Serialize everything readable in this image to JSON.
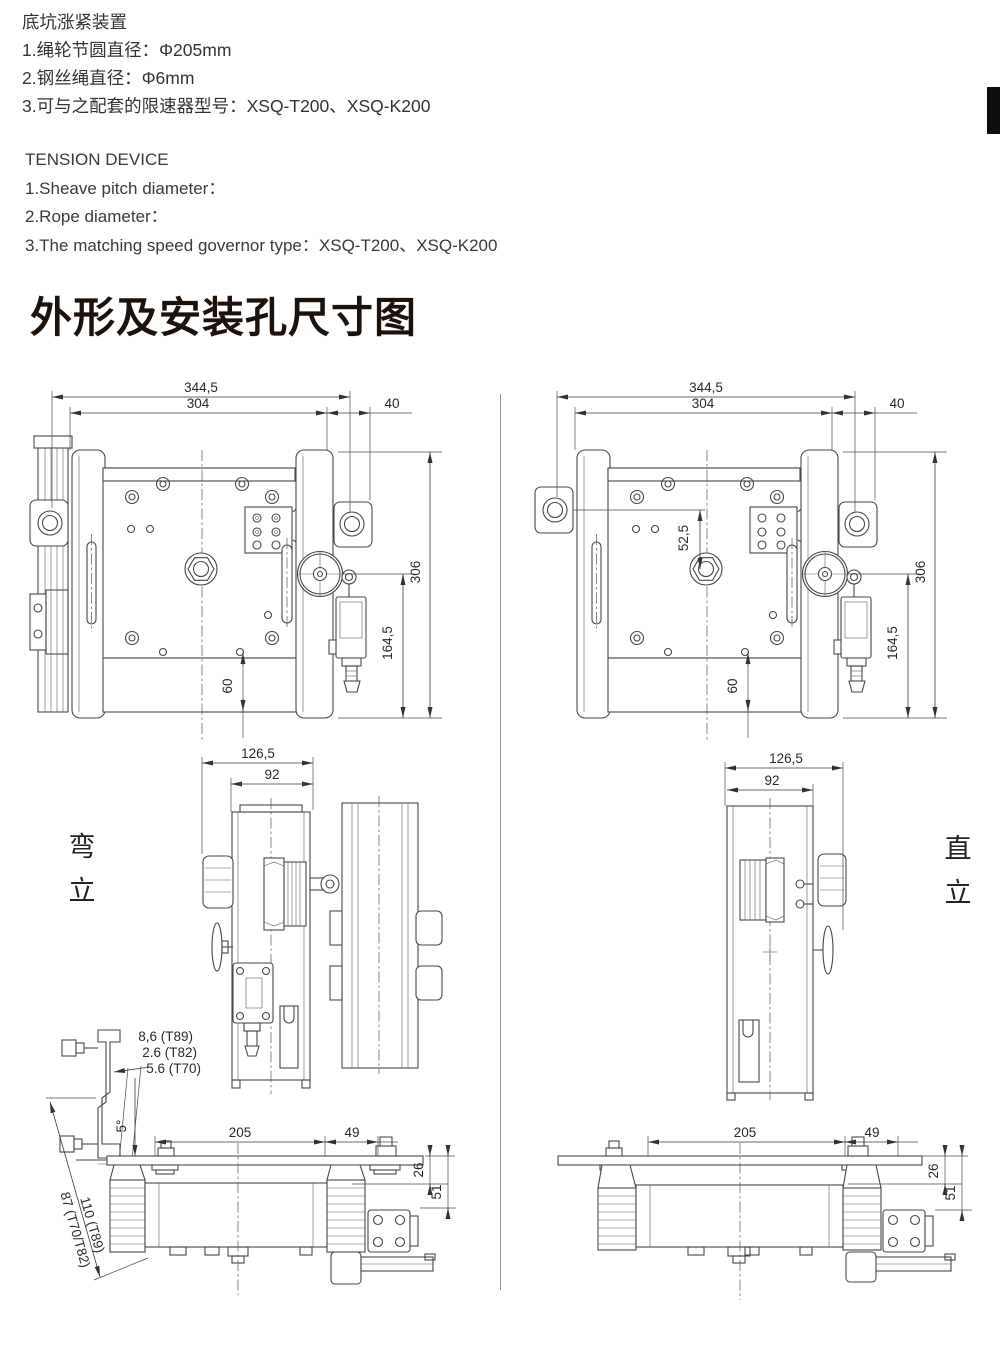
{
  "header_cn": {
    "title": "底坑涨紧装置",
    "items": [
      "1.绳轮节圆直径：Φ205mm",
      "2.钢丝绳直径：Φ6mm",
      "3.可与之配套的限速器型号：XSQ-T200、XSQ-K200"
    ]
  },
  "header_en": {
    "title": "TENSION DEVICE",
    "items": [
      "1.Sheave pitch diameter：",
      "2.Rope diameter：",
      "3.The matching speed governor type：XSQ-T200、XSQ-K200"
    ]
  },
  "section_title": "外形及安装孔尺寸图",
  "view_labels": {
    "bent": [
      "弯",
      "立"
    ],
    "upright": [
      "直",
      "立"
    ]
  },
  "dims": {
    "front": {
      "outer_width": "344,5",
      "inner_width": "304",
      "side_offset": "40",
      "height": "306",
      "switch_height": "164,5",
      "bottom_offset": "60",
      "hole_offset": "52,5"
    },
    "side": {
      "outer_width": "126,5",
      "inner_width": "92"
    },
    "bottom": {
      "body_width": "205",
      "ext_width": "49",
      "plate_gap": "26",
      "seat_gap": "51",
      "offset_t89": "8,6 (T89)",
      "offset_t82": "2.6 (T82)",
      "offset_t70": "5.6 (T70)",
      "tilt_angle": "5°",
      "length_t89": "110 (T89)",
      "length_t70_t82": "87 (T70/T82)"
    }
  },
  "colors": {
    "line": "#474747",
    "text": "#2f2f2f",
    "side_tab": "#0d0d0d"
  }
}
